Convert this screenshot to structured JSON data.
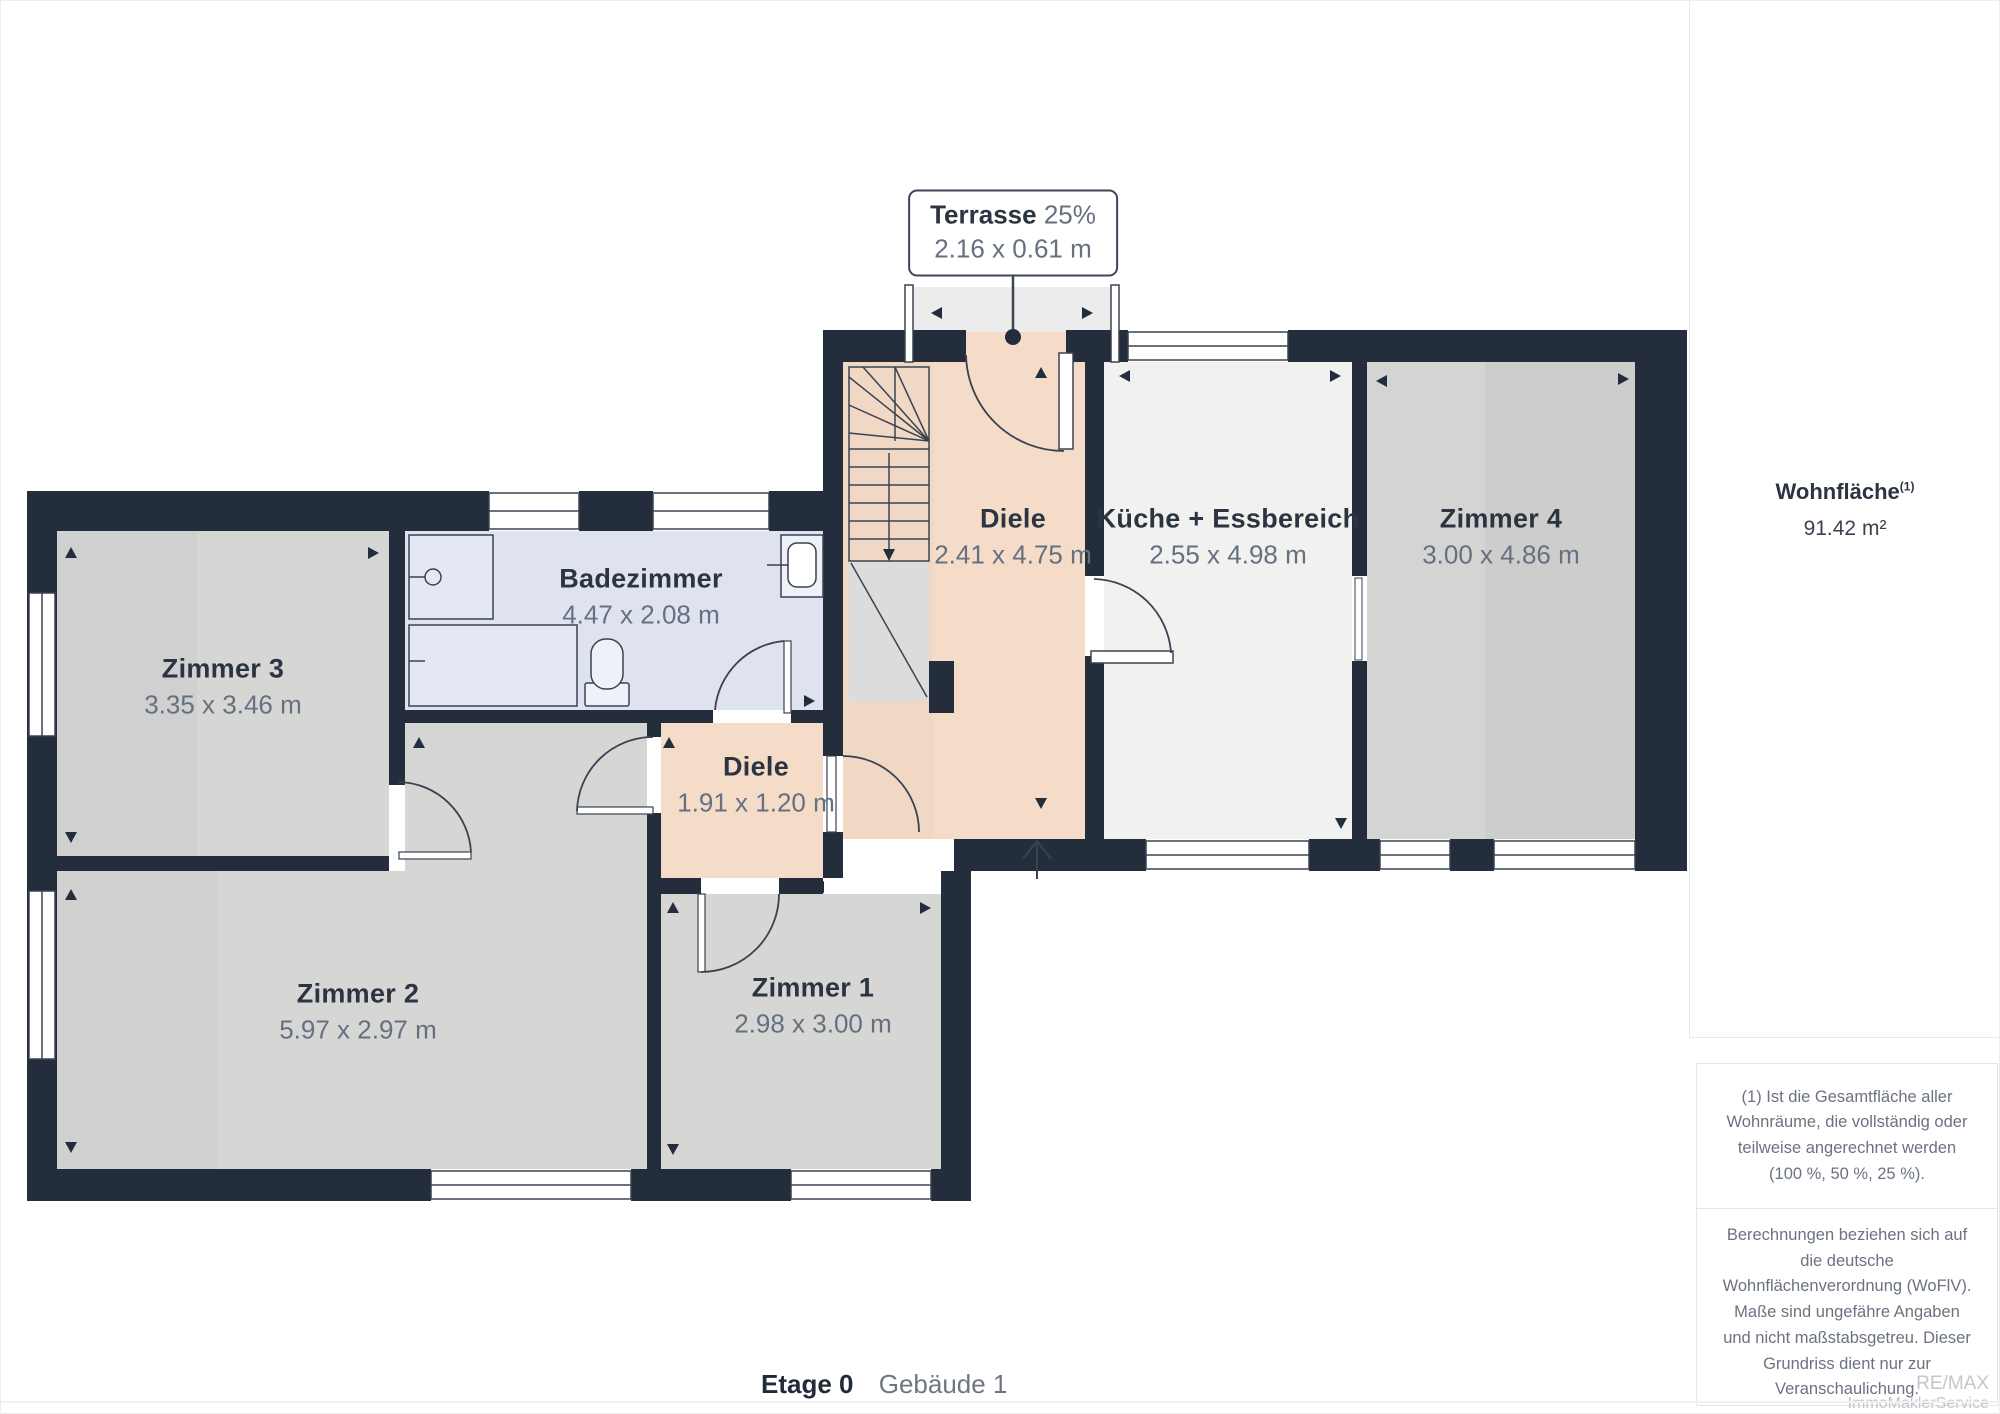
{
  "terrasse": {
    "name": "Terrasse",
    "percent": "25%",
    "dims": "2.16 x 0.61 m"
  },
  "rooms": {
    "zimmer3": {
      "name": "Zimmer 3",
      "dims": "3.35 x 3.46 m"
    },
    "badezimmer": {
      "name": "Badezimmer",
      "dims": "4.47 x 2.08 m"
    },
    "zimmer2": {
      "name": "Zimmer 2",
      "dims": "5.97 x 2.97 m"
    },
    "zimmer1": {
      "name": "Zimmer 1",
      "dims": "2.98 x 3.00 m"
    },
    "diele_klein": {
      "name": "Diele",
      "dims": "1.91 x 1.20 m"
    },
    "diele": {
      "name": "Diele",
      "dims": "2.41 x 4.75 m"
    },
    "kueche": {
      "name": "Küche + Essbereich",
      "dims": "2.55 x 4.98 m"
    },
    "zimmer4": {
      "name": "Zimmer 4",
      "dims": "3.00 x 4.86 m"
    }
  },
  "sidebar": {
    "area_label": "Wohnfläche",
    "area_sup": "(1)",
    "area_value": "91.42 m²",
    "footnote1": "(1) Ist die Gesamtfläche aller Wohnräume, die vollständig oder teilweise angerechnet werden (100 %, 50 %, 25 %).",
    "footnote2": "Berechnungen beziehen sich auf die deutsche Wohnflächenverordnung (WoFlV). Maße sind ungefähre Angaben und nicht maßstabsgetreu. Dieser Grundriss dient nur zur Veranschaulichung.",
    "logo_giraffe": "GIRAFFE",
    "logo_360": "360",
    "brand_line1": "RE/MAX",
    "brand_line2": "ImmoMaklerService"
  },
  "footer": {
    "floor_label": "Etage 0",
    "building_label": "Gebäude 1"
  },
  "colors": {
    "wall": "#242d3b",
    "room_gray": "#d6d6d5",
    "kitchen": "#f1f1f0",
    "bathroom": "#dfe3f0",
    "hallway": "#f4dcc9",
    "terrace": "#ececec",
    "line": "#3a4252"
  }
}
